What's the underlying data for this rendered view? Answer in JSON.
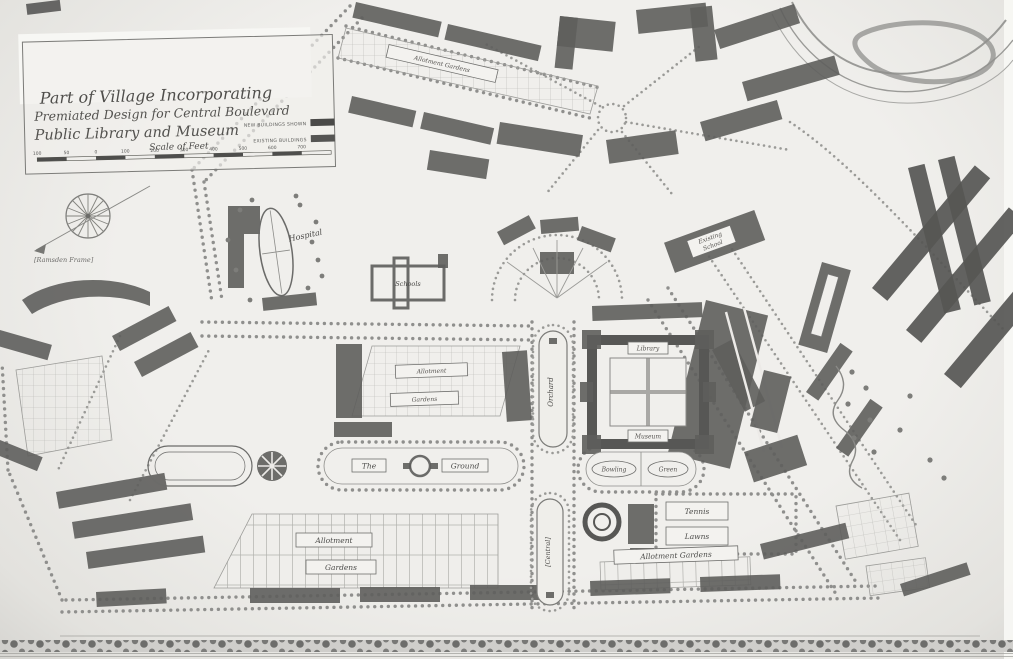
{
  "cartouche": {
    "title_line1": "Part of Village Incorporating",
    "title_line2": "Premiated Design for Central Boulevard",
    "title_line3": "Public Library and Museum",
    "scale_label": "Scale of Feet",
    "scale_ticks": [
      "100",
      "50",
      "0",
      "100",
      "200",
      "300",
      "400",
      "500",
      "600",
      "700"
    ],
    "legend": [
      {
        "label": "NEW BUILDINGS SHOWN",
        "swatch": "#4a4a48"
      },
      {
        "label": "EXISTING BUILDINGS",
        "swatch": "#555553"
      }
    ]
  },
  "annotations": {
    "frame_note": "[Ramsden Frame]"
  },
  "labels": {
    "allotment_top": "Allotment Gardens",
    "hospital": "Hospital",
    "schools": "Schools",
    "school_line1": "Existing",
    "school_line2": "School",
    "allotment_mid_1": "Allotment",
    "allotment_mid_2": "Gardens",
    "ground_left": "The",
    "ground_right": "Ground",
    "bowling": "Bowling",
    "green": "Green",
    "tennis_top": "Tennis",
    "tennis_bottom": "Lawns",
    "allotment_right": "Allotment Gardens",
    "allotment_bottom_1": "Allotment",
    "allotment_bottom_2": "Gardens",
    "blvd_upper": "Orchard",
    "blvd_lower": "[Central]",
    "library": "Library",
    "museum": "Museum"
  },
  "colors": {
    "paper": "#eceae7",
    "ink": "#5a5a58",
    "new_building": "#5e5e5c",
    "existing_building": "#565654"
  }
}
